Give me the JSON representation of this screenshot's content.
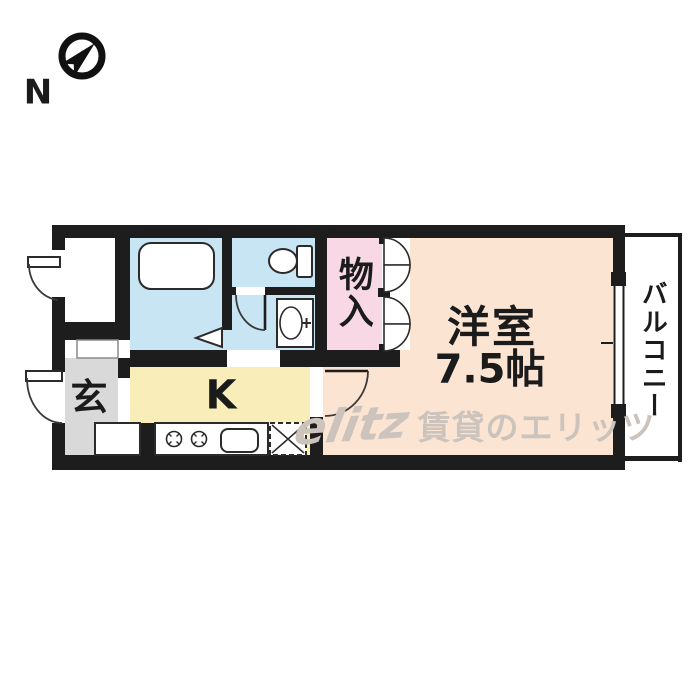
{
  "compass": {
    "label": "N"
  },
  "rooms": {
    "storage_room": {
      "color": "#ffffff"
    },
    "entrance": {
      "label": "玄",
      "color": "#d9d9d9"
    },
    "kitchen": {
      "label": "K",
      "color": "#f9eeba"
    },
    "bathroom": {
      "color": "#c8e5f4"
    },
    "toilet": {
      "color": "#c8e5f4"
    },
    "washroom": {
      "color": "#c8e5f4"
    },
    "closet": {
      "label": "物入",
      "color": "#f8d8e4"
    },
    "western_room": {
      "label": "洋室",
      "size": "7.5帖",
      "color": "#fbe4d2"
    },
    "balcony": {
      "label": "バルコニー",
      "color": "#ffffff"
    }
  },
  "watermark": {
    "logo": "elitz",
    "text": "賃貸のエリッツ",
    "color": "#cbc3bc"
  },
  "wall_color": "#1d1d1d"
}
